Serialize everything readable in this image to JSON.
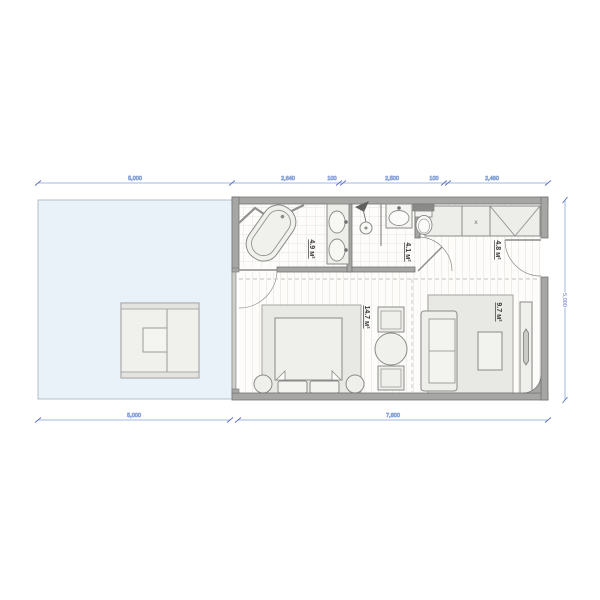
{
  "dimensions": {
    "top_terrace": "5,000",
    "top_segments": [
      "2,640",
      "100",
      "2,500",
      "100",
      "2,460"
    ],
    "bottom_terrace": "5,000",
    "bottom_plan": "7,800",
    "right_height": "5,000"
  },
  "rooms": {
    "bathroom": {
      "area": "4.9 м²"
    },
    "shower_wc": {
      "area": "4.1 м²"
    },
    "entry_hall": {
      "area": "4.8 м²"
    },
    "bedroom": {
      "area": "14.7 м²"
    },
    "living": {
      "area": "9.7 м²"
    }
  },
  "markers": {
    "wardrobe_unit": "x"
  },
  "colors": {
    "terrace_fill": "#e9f1f9",
    "wall": "#a6a6a4",
    "wall_edge": "#757573",
    "furniture_fill": "#eeeeeb",
    "furniture_stroke": "#8a8a88",
    "dimension": "#7b94d6",
    "label_text": "#3a3a3a"
  }
}
